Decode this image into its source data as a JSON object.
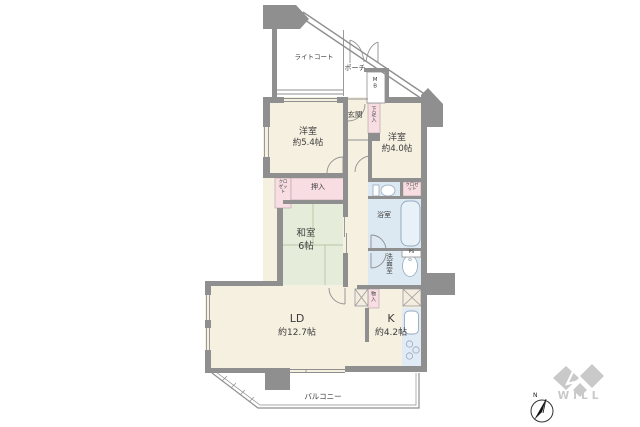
{
  "rooms": {
    "light_court": {
      "label": "ライトコート"
    },
    "porch": {
      "label": "ポーチ"
    },
    "meter_box": {
      "label": "MB"
    },
    "entrance": {
      "label": "玄関"
    },
    "shoe_box": {
      "label": "下足入"
    },
    "western_room_1": {
      "label": "洋室",
      "size": "約5.4帖"
    },
    "western_room_2": {
      "label": "洋室",
      "size": "約4.0帖"
    },
    "closet_1": {
      "label": "クロゼット"
    },
    "oshiire": {
      "label": "押入"
    },
    "closet_2": {
      "label": "クロゼット"
    },
    "japanese_room": {
      "label": "和室",
      "size": "6帖"
    },
    "bathroom": {
      "label": "浴室"
    },
    "pipe_space": {
      "label": "PS"
    },
    "washroom": {
      "label": "洗面室"
    },
    "storage": {
      "label": "物入"
    },
    "living_dining": {
      "label": "LD",
      "size": "約12.7帖"
    },
    "kitchen": {
      "label": "K",
      "size": "約4.2帖"
    },
    "balcony": {
      "label": "バルコニー"
    }
  },
  "branding": {
    "logo_text": "WILL"
  },
  "compass": {
    "north_label": "N"
  },
  "colors": {
    "wall": "#8f8f8f",
    "floor": "#f6f0e1",
    "tatami": "#e5edda",
    "wet_area": "#dce9f2",
    "storage_pink": "#f8dde3",
    "counter": "#e0ebf5",
    "fixture_line": "#95a9bf",
    "logo_gray": "#c9c9c9",
    "text": "#3c3c3c"
  }
}
